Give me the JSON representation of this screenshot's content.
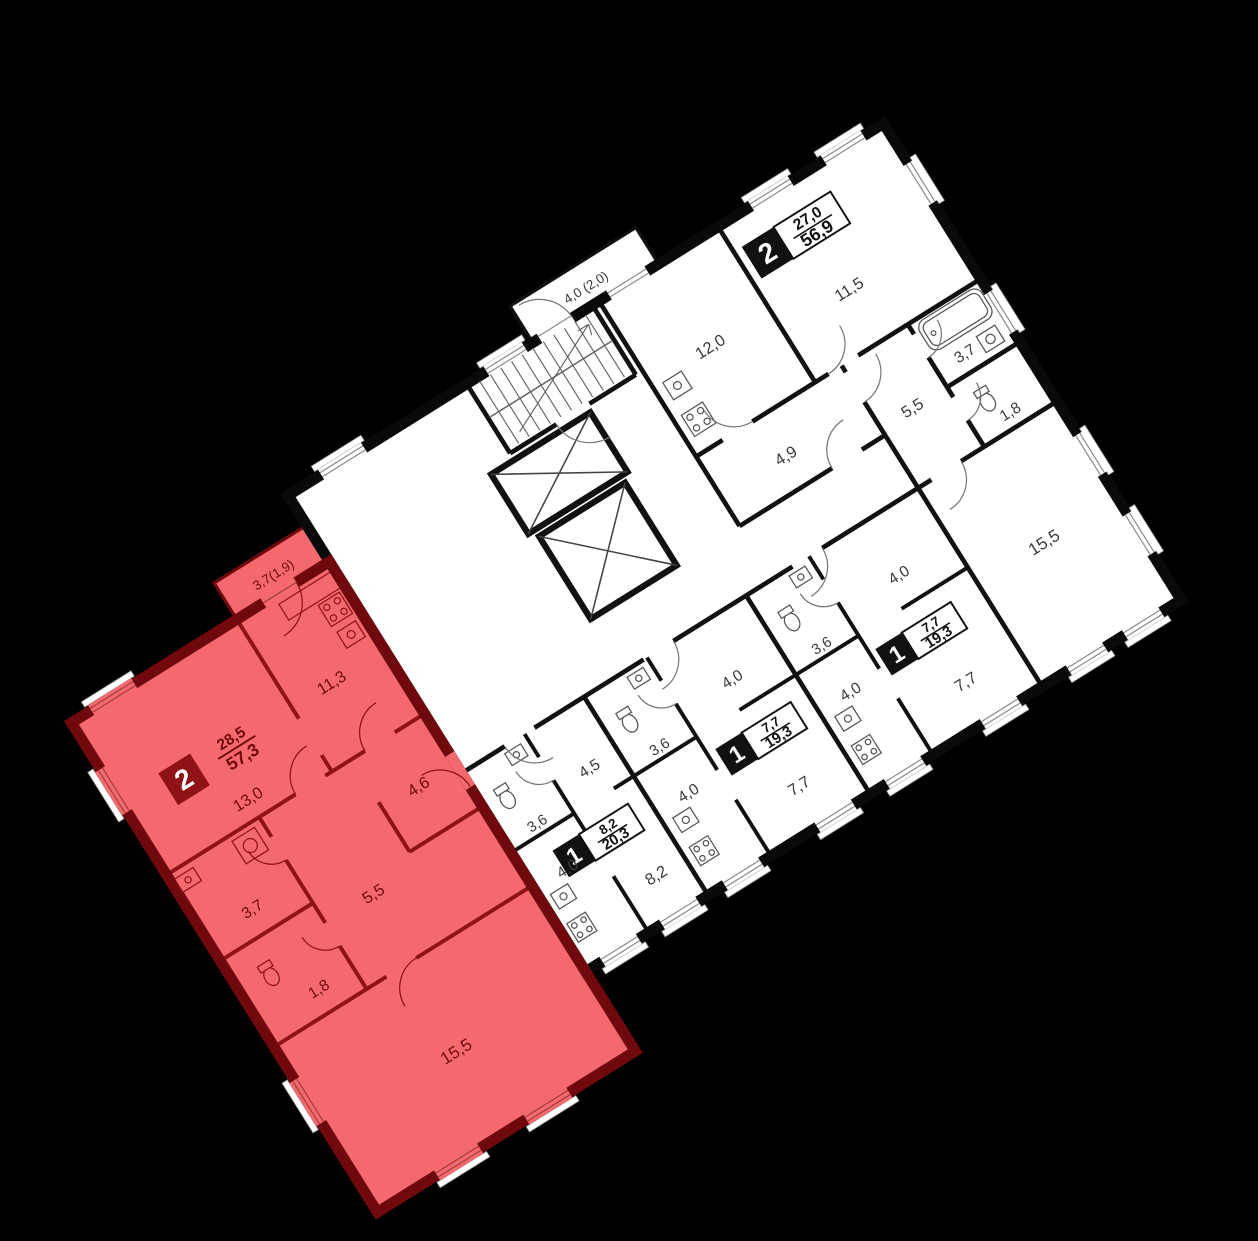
{
  "colors": {
    "background": "#000000",
    "floor": "#ffffff",
    "walls": "#111111",
    "highlight_fill": "#f4696d",
    "highlight_wall": "#70090e",
    "highlight_badge": "#8f1217"
  },
  "plan": {
    "highlight": {
      "badge_rooms": "2",
      "area_living": "28,5",
      "area_total": "57,3",
      "balcony": "3,7(1,9)",
      "kitchen": "11,3",
      "living": "13,0",
      "bath": "3,7",
      "wc": "1,8",
      "hall_a": "5,5",
      "hall_b": "4,6",
      "living2": "15,5"
    },
    "apt2": {
      "badge_rooms": "2",
      "area_living": "27,0",
      "area_total": "56,9",
      "kitchen": "12,0",
      "room": "11,5",
      "bath": "3,7",
      "wc": "1,8",
      "hall_a": "4,9",
      "hall_b": "5,5",
      "living": "15,5"
    },
    "studio_a": {
      "badge_rooms": "1",
      "area_living": "8,2",
      "area_total": "20,3",
      "bath": "3,6",
      "hall": "4,5",
      "kitchen": "4,0",
      "room": "8,2"
    },
    "studio_b": {
      "badge_rooms": "1",
      "area_living": "7,7",
      "area_total": "19,3",
      "bath": "3,6",
      "hall": "4,0",
      "kitchen": "4,0",
      "room": "7,7"
    },
    "studio_c": {
      "badge_rooms": "1",
      "area_living": "7,7",
      "area_total": "19,3",
      "bath": "3,6",
      "hall": "4,0",
      "kitchen": "4,0",
      "room": "7,7"
    },
    "core": {
      "balcony": "4,0 (2,0)"
    }
  }
}
